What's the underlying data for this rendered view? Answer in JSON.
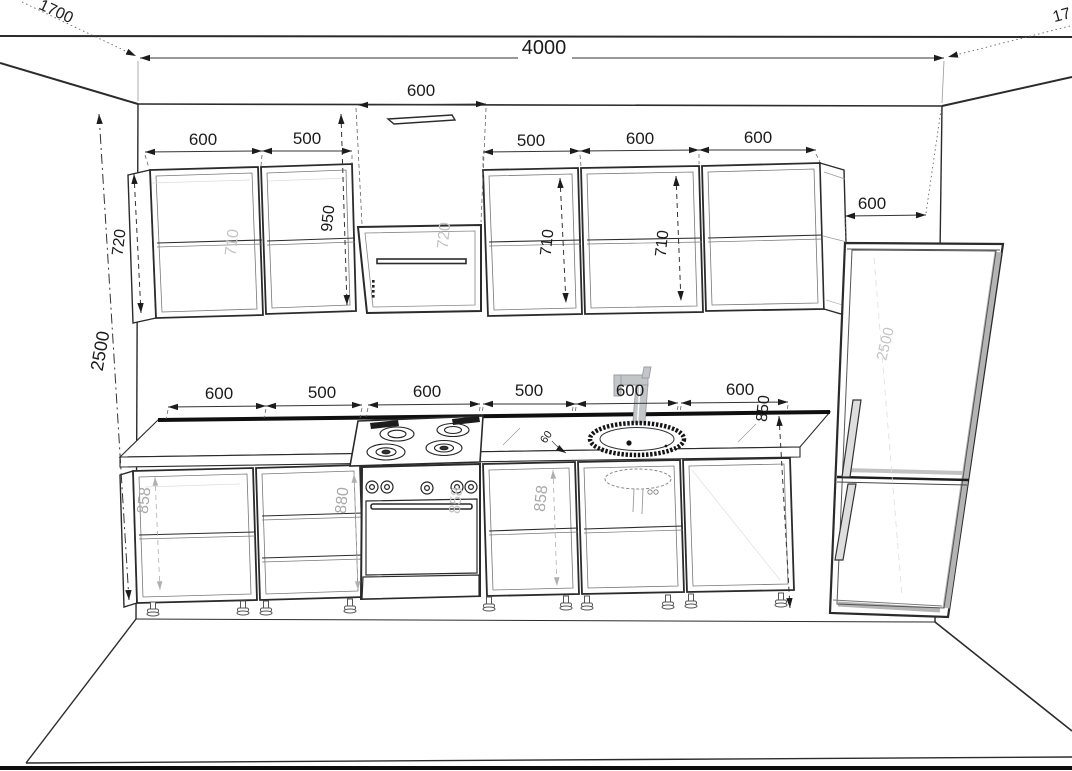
{
  "drawing": {
    "kind": "kitchen-elevation-perspective",
    "colors": {
      "line": "#2b2b2b",
      "bold_line": "#111111",
      "ghost": "#a9a9a9",
      "metal": "#c2c6c9"
    }
  },
  "dims": {
    "room_width": "4000",
    "room_height": "2500",
    "side_depth_left": "1700",
    "side_depth_right": "17",
    "hood_width": "600",
    "upper_left_1": "600",
    "upper_left_2": "500",
    "upper_right_1": "500",
    "upper_right_2": "600",
    "upper_right_3": "600",
    "upper_height": "720",
    "upper_inner_ghost": "710",
    "hood_zone_height": "950",
    "hood_inner_ghost": "720",
    "upper_right_inner_1": "710",
    "upper_right_inner_2": "710",
    "fridge_width": "600",
    "fridge_height_ghost": "2500",
    "base_1": "600",
    "base_2": "500",
    "base_3": "600",
    "base_4": "500",
    "base_5": "600",
    "base_6": "600",
    "counter_height": "850",
    "base_inner_1": "858",
    "base_inner_2": "880",
    "base_inner_3": "858",
    "base_inner_4": "858",
    "counter_detail": "60"
  }
}
